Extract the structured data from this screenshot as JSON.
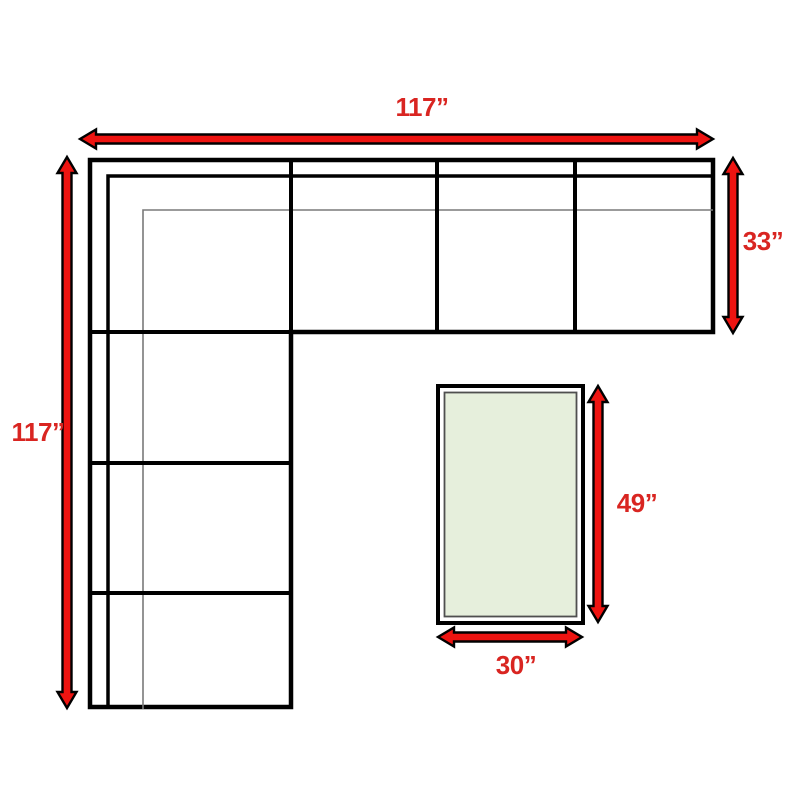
{
  "page": {
    "background": "#ffffff",
    "description": "Top-down furniture dimension diagram of an L-shaped sectional sofa with a rectangular table"
  },
  "colors": {
    "arrow_fill": "#ee1411",
    "arrow_outline": "#000000",
    "label_red": "#d92521",
    "sofa_line": "#000000",
    "sofa_thin_line": "#7a7a7a",
    "table_border": "#000000",
    "table_inner_border": "#4f4f4f",
    "table_top_fill": "#e6efdc"
  },
  "diagram": {
    "sofa": {
      "name": "sectional-sofa",
      "shape": "L-shaped",
      "width_label": "117”",
      "height_label": "117”",
      "depth_label": "33”",
      "top_row_sections": 4,
      "left_column_sections": 4
    },
    "table": {
      "name": "table",
      "shape": "rectangle",
      "length_label": "49”",
      "width_label": "30”"
    }
  },
  "labels": {
    "sofa_width": "117”",
    "sofa_height": "117”",
    "sofa_depth": "33”",
    "table_length": "49”",
    "table_width": "30”"
  }
}
